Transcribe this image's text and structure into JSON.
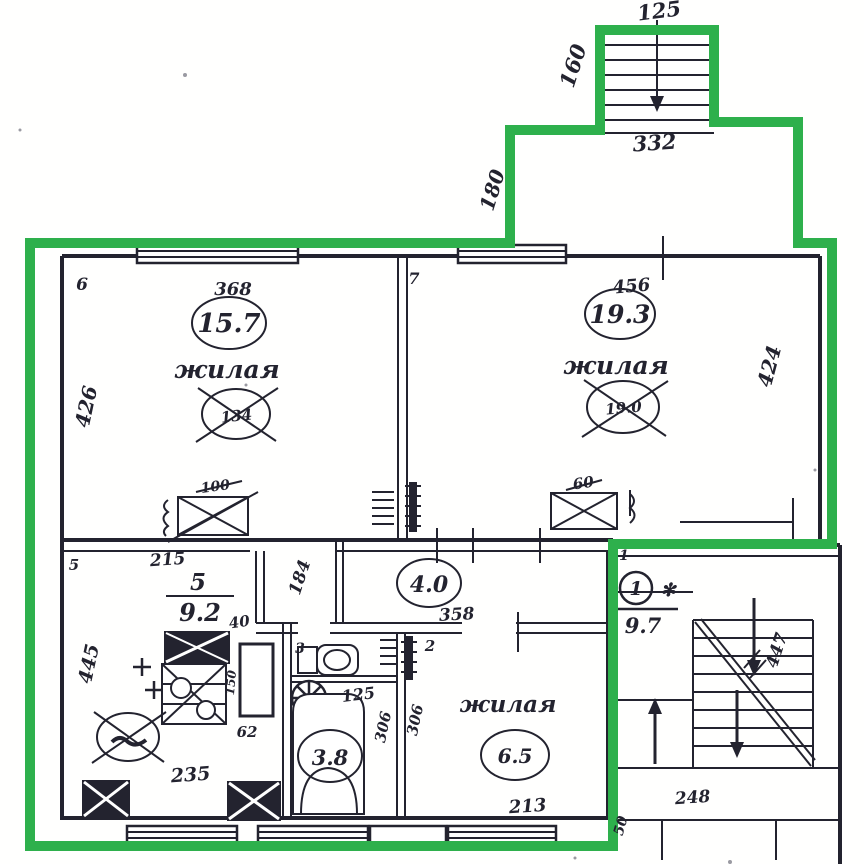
{
  "palette": {
    "boundary_green": "#2eb04c",
    "ink": "#23232f",
    "paper": "#fffffe"
  },
  "plan": {
    "top_staircase": {
      "width": "125",
      "side": "160",
      "landing": "332"
    },
    "vestibule": {
      "side": "180"
    },
    "room6": {
      "corner": "6",
      "top_dim": "368",
      "area": "15.7",
      "name": "жилая",
      "old_value": "134",
      "side_dim": "426",
      "vent_dim": "100"
    },
    "room7": {
      "corner": "7",
      "top_dim": "456",
      "area": "19.3",
      "name": "жилая",
      "old_value": "19.0",
      "side_dim": "424",
      "vent_dim": "60"
    },
    "kitchen": {
      "corner": "5",
      "top_dim": "215",
      "room_no": "5",
      "area": "9.2",
      "door_dim": "40",
      "side_dim": "445",
      "cabinet_dim": "150",
      "niche_dim": "62",
      "bottom_dim": "235"
    },
    "hall": {
      "area": "4.0",
      "width_dim": "358",
      "depth_dim": "184"
    },
    "wc": {
      "corner": "3"
    },
    "bath": {
      "area": "3.8",
      "top_dim": "125",
      "wall_dim_left": "306",
      "wall_dim_right": "306"
    },
    "room2": {
      "corner": "2",
      "name": "жилая",
      "area": "6.5",
      "bottom_dim": "213"
    },
    "stairwell": {
      "corner": "1",
      "unit_no": "1",
      "asterisk": "✻",
      "area": "9.7",
      "flight_dim": "447",
      "bottom_dim": "248",
      "porch_dim": "50"
    }
  }
}
